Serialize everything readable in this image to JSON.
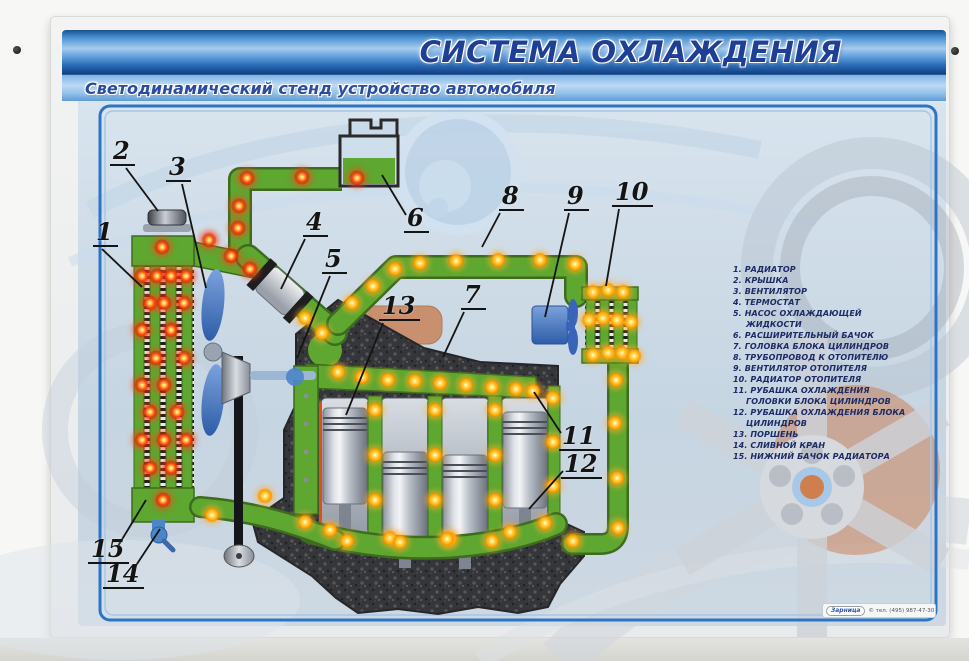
{
  "poster": {
    "title": "СИСТЕМА ОХЛАЖДЕНИЯ",
    "subtitle": "Светодинамический стенд устройство автомобиля",
    "footer_brand": "Зарница",
    "footer_phone": "© тел. (495) 987-47-30"
  },
  "legend": {
    "items": [
      "1. РАДИАТОР",
      "2. КРЫШКА",
      "3. ВЕНТИЛЯТОР",
      "4. ТЕРМОСТАТ",
      "5. НАСОС ОХЛАЖДАЮЩЕЙ ЖИДКОСТИ",
      "6. РАСШИРИТЕЛЬНЫЙ БАЧОК",
      "7. ГОЛОВКА БЛОКА ЦИЛИНДРОВ",
      "8. ТРУБОПРОВОД К ОТОПИТЕЛЮ",
      "9. ВЕНТИЛЯТОР ОТОПИТЕЛЯ",
      "10. РАДИАТОР ОТОПИТЕЛЯ",
      "11. РУБАШКА ОХЛАЖДЕНИЯ ГОЛОВКИ БЛОКА ЦИЛИНДРОВ",
      "12. РУБАШКА ОХЛАЖДЕНИЯ БЛОКА ЦИЛИНДРОВ",
      "13. ПОРШЕНЬ",
      "14. СЛИВНОЙ КРАН",
      "15. НИЖНИЙ БАЧОК РАДИАТОРА"
    ]
  },
  "diagram": {
    "colors": {
      "pipe_green": "#5ea730",
      "pipe_green_dark": "#3e6b1e",
      "led_red": "#ff3b10",
      "led_orange": "#ffa000",
      "banner_blue": "#2f6fc0",
      "legend_text": "#1c2a66"
    },
    "callouts": [
      {
        "n": "1",
        "nx": 93,
        "ny": 219,
        "x1": 102,
        "y1": 249,
        "x2": 142,
        "y2": 287
      },
      {
        "n": "2",
        "nx": 110,
        "ny": 138,
        "x1": 126,
        "y1": 168,
        "x2": 158,
        "y2": 211
      },
      {
        "n": "3",
        "nx": 166,
        "ny": 154,
        "x1": 182,
        "y1": 184,
        "x2": 206,
        "y2": 288
      },
      {
        "n": "4",
        "nx": 303,
        "ny": 209,
        "x1": 305,
        "y1": 239,
        "x2": 281,
        "y2": 289
      },
      {
        "n": "5",
        "nx": 322,
        "ny": 246,
        "x1": 330,
        "y1": 276,
        "x2": 297,
        "y2": 358
      },
      {
        "n": "6",
        "nx": 404,
        "ny": 205,
        "x1": 406,
        "y1": 215,
        "x2": 382,
        "y2": 175
      },
      {
        "n": "7",
        "nx": 461,
        "ny": 282,
        "x1": 464,
        "y1": 312,
        "x2": 443,
        "y2": 357
      },
      {
        "n": "8",
        "nx": 499,
        "ny": 183,
        "x1": 500,
        "y1": 213,
        "x2": 482,
        "y2": 247
      },
      {
        "n": "9",
        "nx": 564,
        "ny": 183,
        "x1": 569,
        "y1": 213,
        "x2": 545,
        "y2": 317
      },
      {
        "n": "10",
        "nx": 612,
        "ny": 179,
        "x1": 619,
        "y1": 209,
        "x2": 606,
        "y2": 286
      },
      {
        "n": "11",
        "nx": 559,
        "ny": 423,
        "x1": 561,
        "y1": 433,
        "x2": 534,
        "y2": 392
      },
      {
        "n": "12",
        "nx": 561,
        "ny": 451,
        "x1": 563,
        "y1": 471,
        "x2": 529,
        "y2": 509
      },
      {
        "n": "13",
        "nx": 379,
        "ny": 293,
        "x1": 383,
        "y1": 323,
        "x2": 346,
        "y2": 415
      },
      {
        "n": "14",
        "nx": 103,
        "ny": 561,
        "x1": 133,
        "y1": 570,
        "x2": 160,
        "y2": 529
      },
      {
        "n": "15",
        "nx": 88,
        "ny": 536,
        "x1": 118,
        "y1": 546,
        "x2": 146,
        "y2": 500
      }
    ],
    "red_leds": [
      [
        247,
        178
      ],
      [
        302,
        177
      ],
      [
        357,
        178
      ],
      [
        239,
        206
      ],
      [
        238,
        228
      ],
      [
        209,
        240
      ],
      [
        162,
        247
      ],
      [
        231,
        256
      ],
      [
        250,
        269
      ],
      [
        142,
        276
      ],
      [
        157,
        276
      ],
      [
        171,
        276
      ],
      [
        186,
        276
      ],
      [
        150,
        303
      ],
      [
        164,
        303
      ],
      [
        184,
        303
      ],
      [
        142,
        330
      ],
      [
        171,
        330
      ],
      [
        156,
        358
      ],
      [
        184,
        358
      ],
      [
        142,
        385
      ],
      [
        164,
        385
      ],
      [
        150,
        412
      ],
      [
        177,
        412
      ],
      [
        142,
        440
      ],
      [
        164,
        440
      ],
      [
        186,
        440
      ],
      [
        150,
        468
      ],
      [
        171,
        468
      ],
      [
        163,
        500
      ]
    ],
    "orange_leds": [
      [
        305,
        318
      ],
      [
        322,
        333
      ],
      [
        338,
        372
      ],
      [
        362,
        377
      ],
      [
        388,
        380
      ],
      [
        415,
        381
      ],
      [
        440,
        383
      ],
      [
        466,
        385
      ],
      [
        492,
        387
      ],
      [
        516,
        389
      ],
      [
        533,
        391
      ],
      [
        352,
        303
      ],
      [
        373,
        286
      ],
      [
        395,
        269
      ],
      [
        420,
        263
      ],
      [
        456,
        261
      ],
      [
        498,
        260
      ],
      [
        540,
        260
      ],
      [
        575,
        264
      ],
      [
        593,
        292
      ],
      [
        608,
        290
      ],
      [
        623,
        292
      ],
      [
        589,
        320
      ],
      [
        603,
        318
      ],
      [
        617,
        320
      ],
      [
        631,
        322
      ],
      [
        593,
        355
      ],
      [
        608,
        353
      ],
      [
        622,
        353
      ],
      [
        634,
        356
      ],
      [
        616,
        380
      ],
      [
        615,
        423
      ],
      [
        617,
        478
      ],
      [
        618,
        528
      ],
      [
        573,
        541
      ],
      [
        375,
        410
      ],
      [
        375,
        455
      ],
      [
        375,
        500
      ],
      [
        435,
        410
      ],
      [
        435,
        455
      ],
      [
        435,
        500
      ],
      [
        495,
        410
      ],
      [
        495,
        455
      ],
      [
        495,
        500
      ],
      [
        553,
        398
      ],
      [
        553,
        442
      ],
      [
        553,
        486
      ],
      [
        330,
        530
      ],
      [
        390,
        538
      ],
      [
        450,
        539
      ],
      [
        510,
        532
      ],
      [
        545,
        523
      ],
      [
        212,
        515
      ],
      [
        265,
        496
      ],
      [
        305,
        522
      ],
      [
        347,
        541
      ],
      [
        400,
        542
      ],
      [
        447,
        539
      ],
      [
        492,
        541
      ]
    ]
  }
}
